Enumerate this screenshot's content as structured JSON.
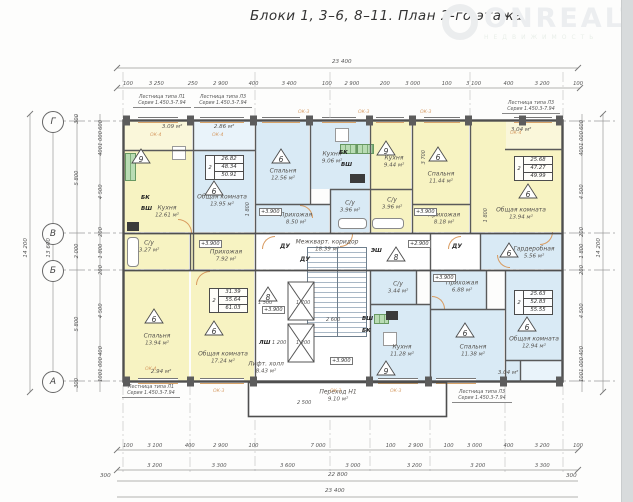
{
  "title": "Блоки 1,  3–6, 8–11.    План 2-го этажа",
  "watermark": {
    "brand": "ONREALT",
    "tagline": "НЕДВИЖИМОСТЬ"
  },
  "colors": {
    "apartment_yellow": "#f7f3c2",
    "apartment_blue": "#d9eaf5",
    "wall": "#4f4f4f",
    "window_accent": "#d59a62"
  },
  "axes": {
    "g": "Г",
    "v": "В",
    "b": "Б",
    "a": "А"
  },
  "dims": {
    "top_overall": "23 400",
    "top_segments": [
      "100",
      "3 250",
      "250",
      "2 900",
      "400",
      "3 400",
      "100",
      "2 900",
      "200",
      "3 000",
      "100",
      "3 100",
      "400",
      "3 200",
      "100"
    ],
    "left_inner": [
      "600",
      "1 000",
      "400",
      "4 500",
      "200",
      "1 800",
      "200",
      "4 500",
      "400",
      "1 000",
      "100"
    ],
    "left_major": [
      "300",
      "5 800",
      "2 000",
      "5 800",
      "300"
    ],
    "left_13600": "13 600",
    "left_overall": "14 200",
    "right_inner": [
      "600",
      "1 000",
      "400",
      "4 500",
      "200",
      "1 800",
      "200",
      "4 500",
      "400",
      "1 000",
      "100"
    ],
    "right_overall": "14 200",
    "bottom_row1": [
      "100",
      "3 100",
      "400",
      "2 900",
      "100",
      "7 000",
      "100",
      "2 900",
      "100",
      "3 000",
      "400",
      "3 200",
      "100"
    ],
    "bottom_row2": [
      "3 200",
      "3 300",
      "3 600",
      "3 000",
      "3 200",
      "3 200",
      "3 300"
    ],
    "bottom_300_left": "300",
    "bottom_300_right": "300",
    "bottom_22800": "22 800",
    "bottom_overall": "23 400",
    "int_3700": "3 700",
    "int_1800a": "1 800",
    "int_1800b": "1 800",
    "int_2600": "2 600",
    "int_1500": "1 500",
    "int_1700": "1 700",
    "int_1200a": "1 200",
    "int_1200b": "1 200",
    "int_2500": "2 500"
  },
  "stair_notes": [
    {
      "t": "Лестница типа Л1",
      "s": "Серия 1.450.3-7.94"
    },
    {
      "t": "Лестница типа Л3",
      "s": "Серия 1.450.3-7.94"
    },
    {
      "t": "Лестница типа Л3",
      "s": "Серия 1.450.3-7.94"
    },
    {
      "t": "Лестница типа Л1",
      "s": "Серия 1.450.3-7.94"
    },
    {
      "t": "Лестница типа Л3",
      "s": "Серия 1.450.3-7.94"
    }
  ],
  "rooms": [
    {
      "name": "Кухня",
      "area": "12.61 м²"
    },
    {
      "name": "Общая комната",
      "area": "13.95 м²"
    },
    {
      "name": "Спальня",
      "area": "12.56 м²"
    },
    {
      "name": "Прихожая",
      "area": "8.50 м²"
    },
    {
      "name": "Кухня",
      "area": "9.06 м²"
    },
    {
      "name": "Кухня",
      "area": "9.44 м²"
    },
    {
      "name": "С/у",
      "area": "3.96 м²"
    },
    {
      "name": "С/у",
      "area": "3.96 м²"
    },
    {
      "name": "Спальня",
      "area": "11.44 м²"
    },
    {
      "name": "Прихожая",
      "area": "8.18 м²"
    },
    {
      "name": "Общая комната",
      "area": "13.94 м²"
    },
    {
      "name": "С/у",
      "area": "3.27 м²"
    },
    {
      "name": "Прихожая",
      "area": "7.92 м²"
    },
    {
      "name": "Межкварт. коридор",
      "area": "18.39 м²"
    },
    {
      "name": "Гардеробная",
      "area": "5.56 м²"
    },
    {
      "name": "Спальня",
      "area": "13.94 м²"
    },
    {
      "name": "Общая комната",
      "area": "17.24 м²"
    },
    {
      "name": "Лифт. холл",
      "area": "8.43 м²"
    },
    {
      "name": "С/у",
      "area": "3.44 м²"
    },
    {
      "name": "Кухня",
      "area": "11.28 м²"
    },
    {
      "name": "Прихожая",
      "area": "6.88 м²"
    },
    {
      "name": "Спальня",
      "area": "11.38 м²"
    },
    {
      "name": "Общая комната",
      "area": "12.94 м²"
    },
    {
      "name": "Переход Н1",
      "area": "9.10 м²"
    },
    {
      "name": "",
      "area": "3.09 м²"
    },
    {
      "name": "",
      "area": "2.86 м²"
    },
    {
      "name": "",
      "area": "3.04 м²"
    },
    {
      "name": "",
      "area": "3.04 м²"
    },
    {
      "name": "",
      "area": "2.94 м²"
    }
  ],
  "tables": [
    {
      "n": "2",
      "r1": "26.82",
      "r2": "48.34",
      "r3": "50.91"
    },
    {
      "n": "2",
      "r1": "25.68",
      "r2": "47.27",
      "r3": "49.99"
    },
    {
      "n": "2",
      "r1": "31.39",
      "r2": "55.64",
      "r3": "61.03"
    },
    {
      "n": "2",
      "r1": "25.63",
      "r2": "52.83",
      "r3": "55.55"
    }
  ],
  "triangles": [
    "9",
    "6",
    "6",
    "9",
    "6",
    "6",
    "8",
    "6",
    "6",
    "8",
    "6",
    "9",
    "6",
    "6"
  ],
  "elev": [
    "+3.900",
    "+3.900",
    "+3.900",
    "+2.900",
    "+3.900",
    "+3.900",
    "+3.900"
  ],
  "shafts": {
    "bk": "БК",
    "vsh": "ВШ",
    "esh": "ЭШ",
    "lsh": "ЛШ",
    "du": "ДУ"
  },
  "windows": {
    "ok3": "ОК-3",
    "ok4": "ОК-4"
  }
}
